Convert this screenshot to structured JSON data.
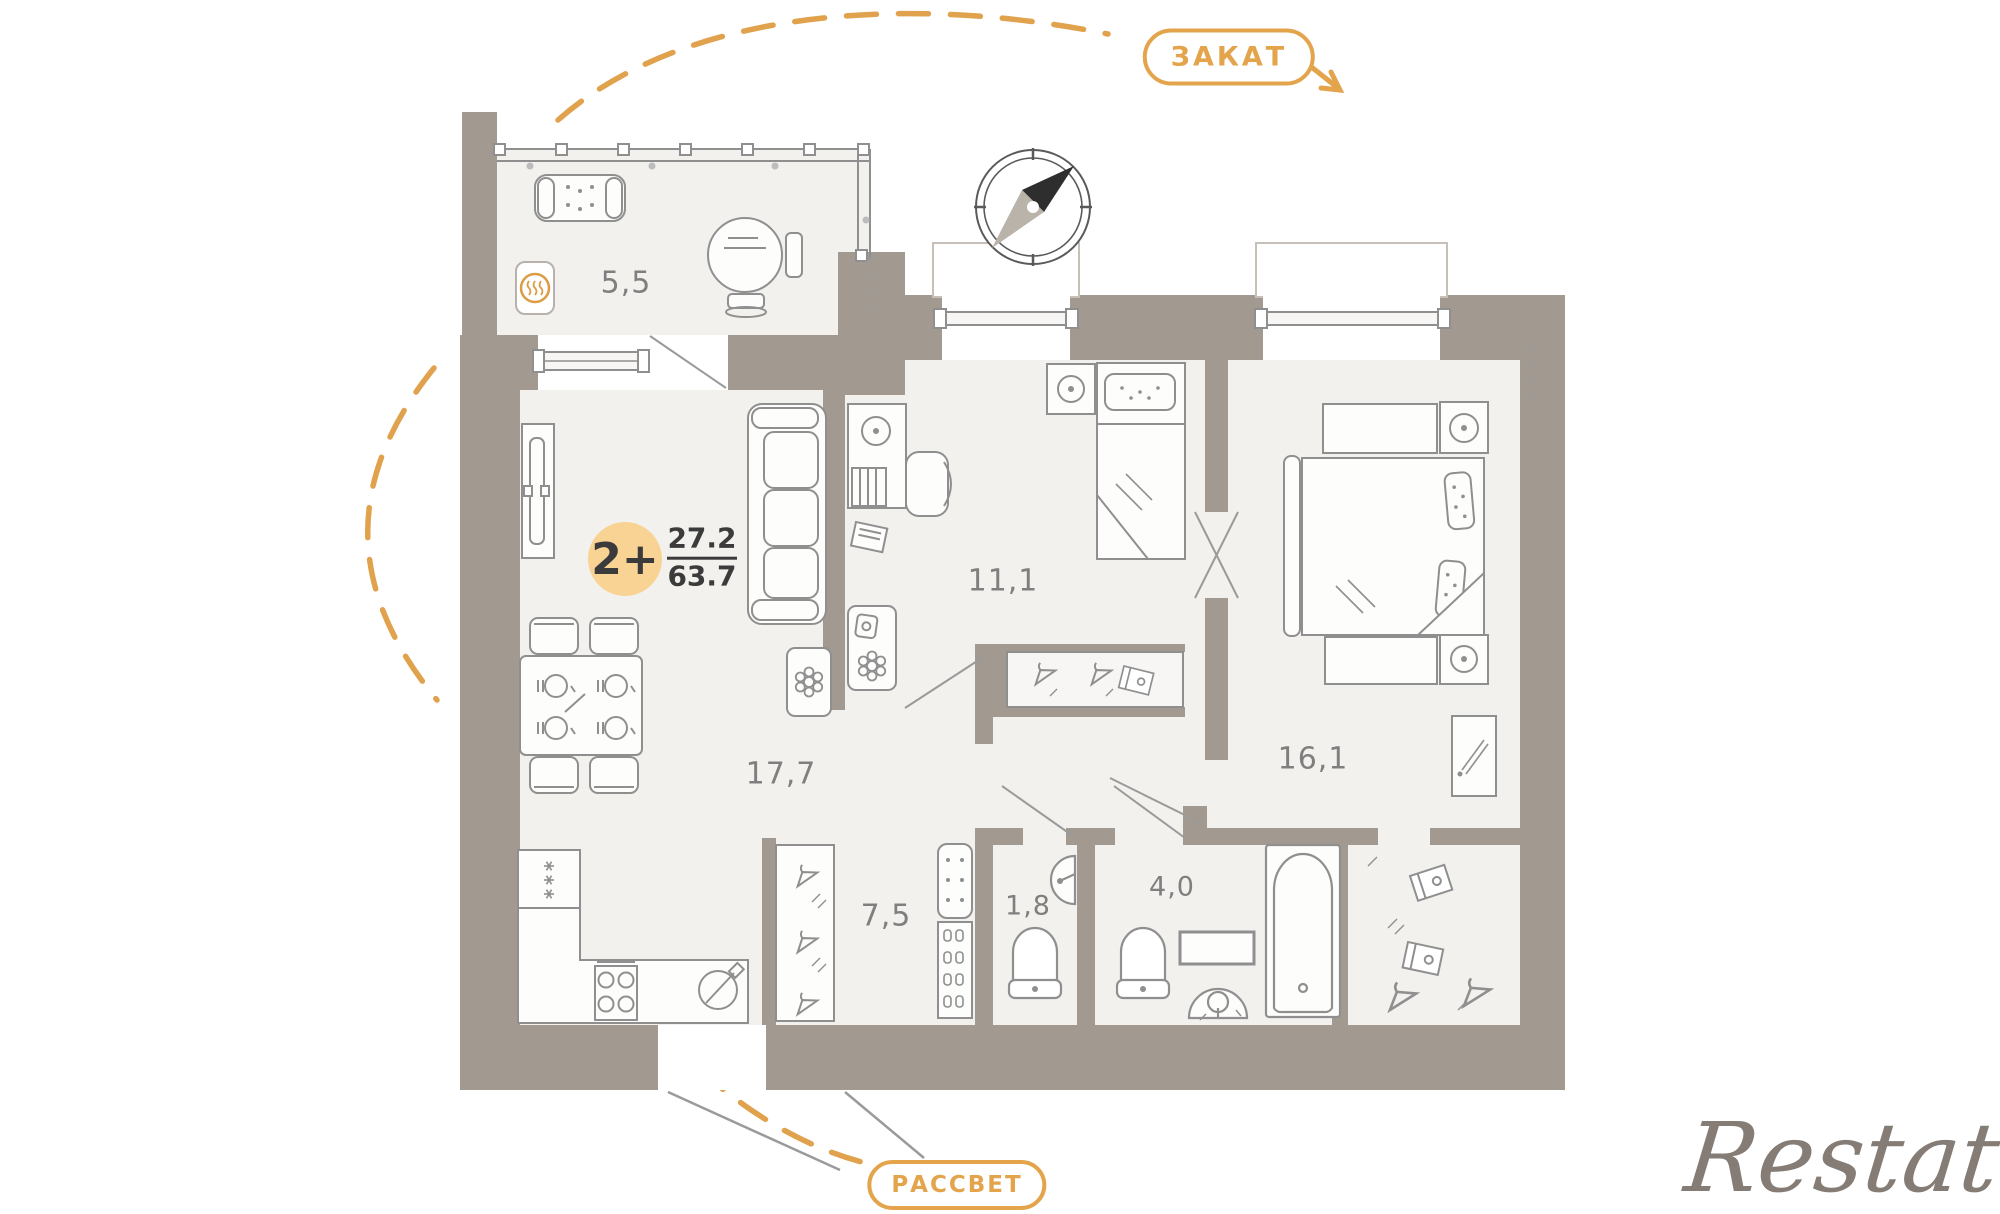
{
  "plan": {
    "badge": {
      "rooms_label": "2+",
      "upper_area": "27.2",
      "lower_area": "63.7"
    },
    "directions": {
      "sunset": "ЗАКАТ",
      "sunrise": "РАССВЕТ"
    },
    "rooms": [
      {
        "name": "balcony",
        "area": "5,5"
      },
      {
        "name": "living-kitchen",
        "area": "17,7"
      },
      {
        "name": "bedroom-1",
        "area": "11,1"
      },
      {
        "name": "bedroom-2",
        "area": "16,1"
      },
      {
        "name": "hallway",
        "area": "7,5"
      },
      {
        "name": "wc",
        "area": "1,8"
      },
      {
        "name": "bathroom",
        "area": "4,0"
      }
    ],
    "watermark": "Restate",
    "colors": {
      "wall": "#a29990",
      "floor": "#f2f1ee",
      "accent": "#e3a44c",
      "badge_fill": "#f8d394"
    }
  }
}
